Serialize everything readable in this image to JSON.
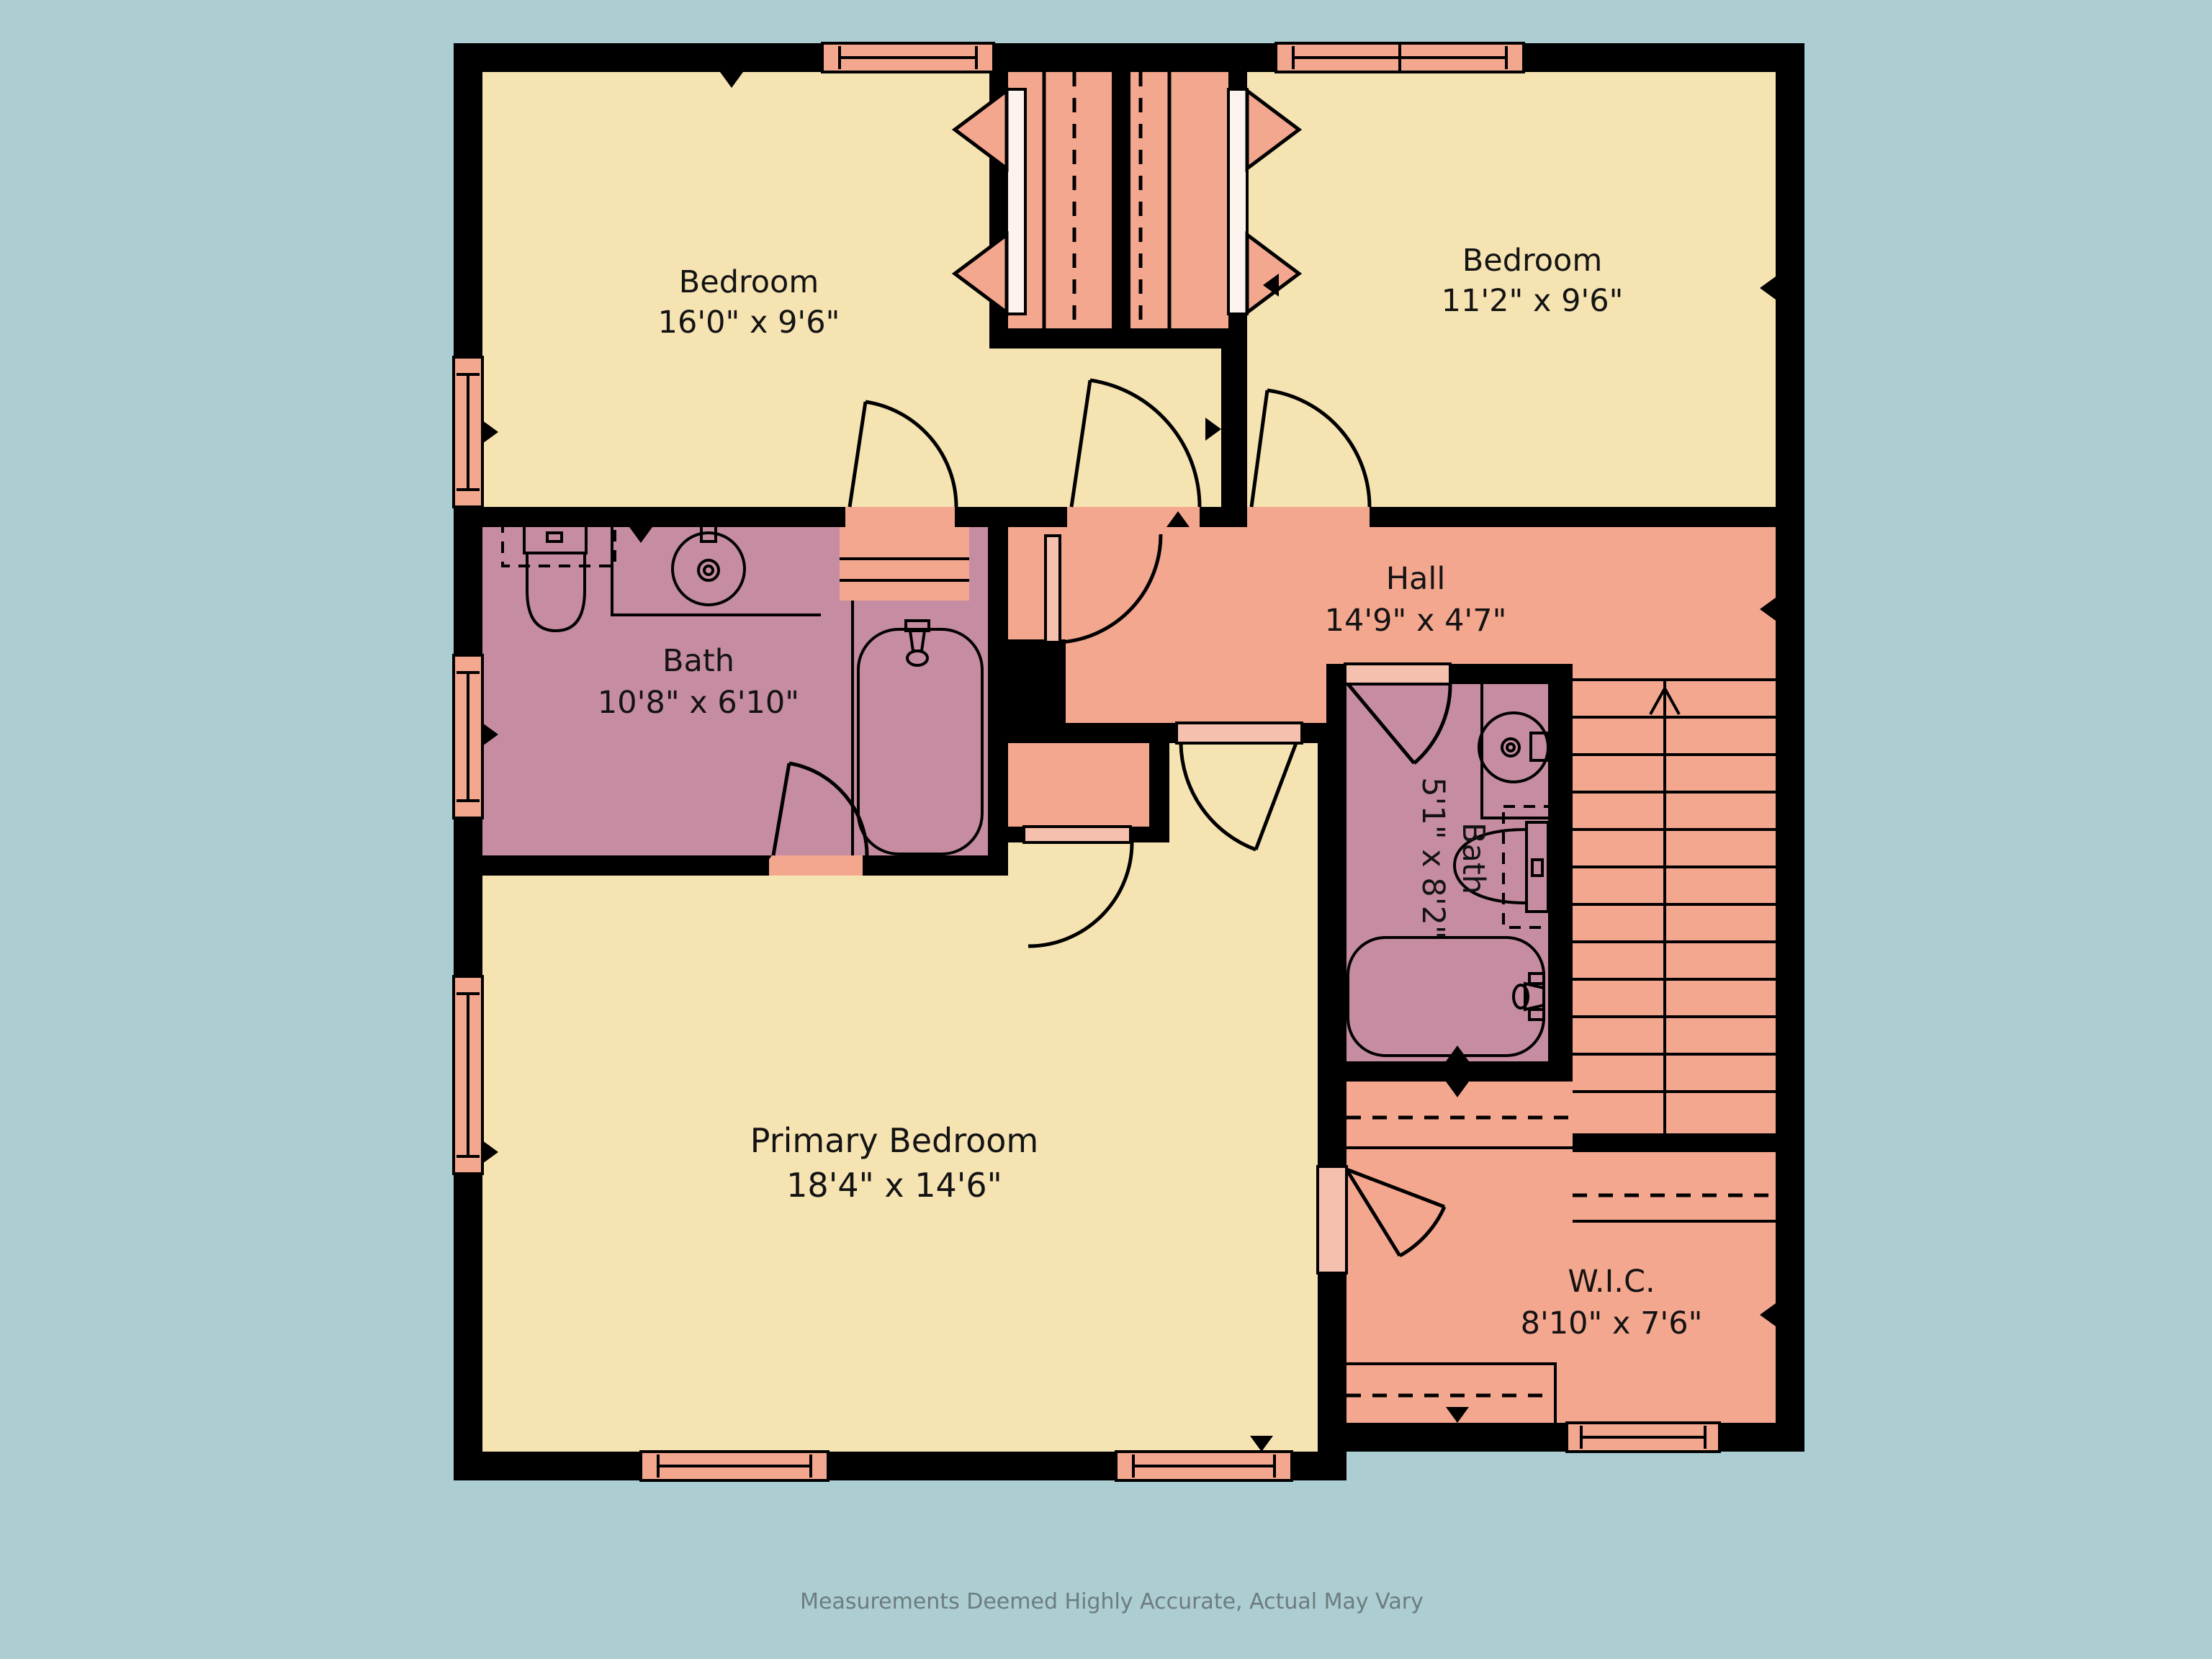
{
  "plan": {
    "type": "floor-plan",
    "rooms": [
      {
        "id": "bedroom-1",
        "name": "Bedroom",
        "dims": "16'0\" x 9'6\""
      },
      {
        "id": "bedroom-2",
        "name": "Bedroom",
        "dims": "11'2\" x 9'6\""
      },
      {
        "id": "hall",
        "name": "Hall",
        "dims": "14'9\" x 4'7\""
      },
      {
        "id": "bath-1",
        "name": "Bath",
        "dims": "10'8\" x 6'10\""
      },
      {
        "id": "bath-2",
        "name": "Bath",
        "dims": "5'1\" x 8'2\""
      },
      {
        "id": "primary-bedroom",
        "name": "Primary Bedroom",
        "dims": "18'4\" x 14'6\""
      },
      {
        "id": "wic",
        "name": "W.I.C.",
        "dims": "8'10\" x 7'6\""
      }
    ],
    "footer": "Measurements Deemed Highly Accurate, Actual May Vary",
    "colors": {
      "background": "#accdd2",
      "bedroom_fill": "#f6e3b2",
      "hall_closet_stairs_fill": "#f4a78f",
      "bath_fill": "#c68ca2",
      "door_leaf_fill": "#f6c0ae",
      "walls": "#000000",
      "label_text": "#131313",
      "footer_text": "#6d7c80"
    }
  }
}
